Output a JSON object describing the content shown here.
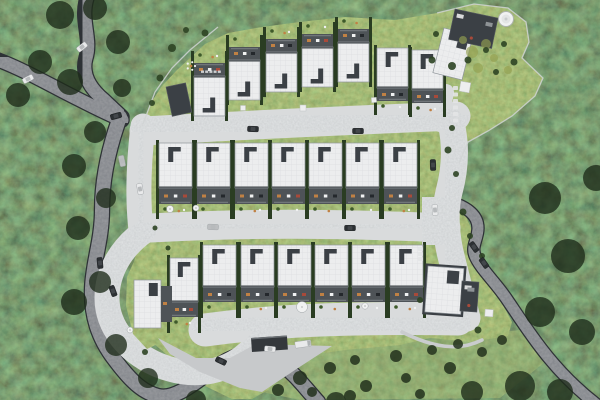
{
  "meta": {
    "scene": "aerial-site-plan-render",
    "width": 600,
    "height": 400
  },
  "colors": {
    "roof": "#ECEDEE",
    "roofGrid": "#DBDDE0",
    "roofEdge": "#8F959A",
    "dark": "#3B4045",
    "darker": "#24282C",
    "terrace": "#4E5357",
    "hedge": "#2A3D22",
    "bush": "#2E4424",
    "lawnTree": "#22301C",
    "cobble": "#B2B6BA",
    "curb": "#D9DBDC",
    "apron": "#C7C9CB",
    "asphalt": "#43474B",
    "asphaltEdge": "#2E3236",
    "carWhite": "#E9EAEB",
    "carDark": "#2C3033",
    "carSilver": "#BCBEC0",
    "orange": "#C08144",
    "red": "#A84A3A",
    "white": "#F1F2F2",
    "fence": "#D0D3D4",
    "stone": "#E3E4E5",
    "meadow": "#93A050",
    "railing": "#7A7F83",
    "canopy": "#1C2A18"
  },
  "site": {
    "outline": "143,124 150,104 162,86 177,70 190,58 205,44 228,33 262,27 300,22 345,17 395,20 437,13 474,4 508,8 526,22 529,42 522,58 543,78 535,96 512,116 488,131 468,142 459,160 461,186 452,200 465,214 475,238 486,268 498,296 512,322 508,336 470,342 430,338 400,345 345,350 310,355 290,368 268,390 252,399 232,399 205,386 175,362 152,342 136,318 130,292 134,262 140,238 138,205 139,170 141,145",
    "island": "148,247 168,254 176,278 176,314 166,340 147,349 133,334 126,306 127,277 136,257",
    "lawn": "250,352 330,346 430,340 520,330 545,362 500,398 300,400 262,392",
    "fences": [
      "218,27 190,50 172,68 155,92 143,124",
      "437,13 474,4 508,8 526,22 529,42 522,58 543,78 535,96 512,116 488,131 468,142 459,163"
    ]
  },
  "roads": {
    "asphalt": [
      {
        "name": "north-access-road",
        "d": "M87,-2 C80,20 92,38 86,58 C81,76 92,90 104,100 C110,106 116,111 122,117",
        "w": 13
      },
      {
        "name": "west-access-road",
        "d": "M-2,60 C25,70 55,88 86,103 C98,109 110,115 122,120",
        "w": 13
      },
      {
        "name": "south-perimeter-road",
        "d": "M120,117 C108,150 102,180 102,210 C102,240 93,262 92,288 C91,315 98,338 115,360 C130,380 142,392 158,396 C180,401 205,372 228,360 C252,348 262,352 278,362 C295,373 305,388 318,402",
        "w": 14
      },
      {
        "name": "east-exit-road",
        "d": "M450,202 C468,207 478,216 478,228 C478,240 470,247 476,258 C482,270 495,282 506,298 C517,314 530,335 548,357 C562,374 578,390 596,404",
        "w": 11
      }
    ],
    "cobble": [
      {
        "name": "upper-lane",
        "d": "M144,131 C230,126 330,121 456,116",
        "w": 26
      },
      {
        "name": "north-east-stub",
        "d": "M446,92 L440,124",
        "w": 13
      },
      {
        "name": "east-connector-lane",
        "d": "M450,119 C457,145 455,170 449,192 C444,212 446,238 452,260 C457,280 462,300 467,318",
        "w": 24
      },
      {
        "name": "middle-lane",
        "d": "M150,228 C240,223 330,223 446,228",
        "w": 26
      },
      {
        "name": "west-connector-lane",
        "d": "M143,126 C139,160 137,195 141,230",
        "w": 22
      },
      {
        "name": "turning-loop",
        "d": "M146,230 C121,247 107,272 107,298 C107,327 128,352 158,365 C190,378 220,374 243,357 C252,350 258,343 263,336",
        "w": 22
      },
      {
        "name": "lower-lane",
        "d": "M205,330 C270,321 340,317 458,319",
        "w": 30
      }
    ],
    "parkingBay": {
      "x": 422,
      "y": 197,
      "w": 26,
      "h": 48
    },
    "apron": "158,338 196,358 230,358 256,344 332,346 298,368 262,392 240,388 200,372 170,354",
    "walkway": "M402,332 C432,347 458,352 482,340"
  },
  "rows": {
    "top": {
      "w": 31,
      "roofH": 40,
      "terrH": 13,
      "gardenH": 12,
      "units": [
        {
          "x": 194,
          "y": 76,
          "terr": "top"
        },
        {
          "x": 229,
          "y": 60,
          "terr": "top"
        },
        {
          "x": 266,
          "y": 52,
          "terr": "top"
        },
        {
          "x": 302,
          "y": 47,
          "terr": "top"
        },
        {
          "x": 338,
          "y": 42,
          "terr": "top"
        },
        {
          "x": 377,
          "y": 48,
          "terr": "bottom"
        },
        {
          "x": 412,
          "y": 50,
          "terr": "bottom"
        }
      ]
    },
    "middle": {
      "w": 33,
      "roofH": 45,
      "terrH": 16,
      "gardenH": 13,
      "units": [
        {
          "x": 159,
          "y": 143,
          "terr": "bottom"
        },
        {
          "x": 197,
          "y": 143,
          "terr": "bottom"
        },
        {
          "x": 235,
          "y": 143,
          "terr": "bottom"
        },
        {
          "x": 272,
          "y": 143,
          "terr": "bottom"
        },
        {
          "x": 309,
          "y": 143,
          "terr": "bottom"
        },
        {
          "x": 346,
          "y": 143,
          "terr": "bottom"
        },
        {
          "x": 384,
          "y": 143,
          "terr": "bottom"
        }
      ]
    },
    "bottom": {
      "w": 33,
      "roofH": 42,
      "terrH": 15,
      "gardenH": 14,
      "units": [
        {
          "x": 170,
          "y": 258,
          "w": 28,
          "roofH": 44,
          "terr": "bottom"
        },
        {
          "x": 203,
          "y": 245,
          "terr": "bottom"
        },
        {
          "x": 241,
          "y": 245,
          "terr": "bottom"
        },
        {
          "x": 278,
          "y": 245,
          "terr": "bottom"
        },
        {
          "x": 315,
          "y": 245,
          "terr": "bottom"
        },
        {
          "x": 352,
          "y": 245,
          "terr": "bottom"
        },
        {
          "x": 390,
          "y": 245,
          "terr": "bottom"
        }
      ]
    }
  },
  "specials": [
    {
      "type": "dark",
      "name": "garage-building",
      "x": 166,
      "y": 87,
      "w": 20,
      "h": 30,
      "rot": -12
    },
    {
      "type": "house",
      "name": "detached-house-ne",
      "x": 444,
      "y": 28,
      "w": 30,
      "h": 46,
      "rot": 14
    },
    {
      "type": "dark",
      "name": "communal-terrace",
      "x": 455,
      "y": 9,
      "w": 44,
      "h": 31,
      "rot": 12,
      "dots": true
    },
    {
      "type": "gazebo",
      "name": "round-gazebo",
      "x": 506,
      "y": 19,
      "r": 7.5
    },
    {
      "type": "house",
      "name": "loop-corner-house",
      "x": 134,
      "y": 280,
      "w": 27,
      "h": 48,
      "rot": 0,
      "sideTerr": true
    },
    {
      "type": "house",
      "name": "clubhouse",
      "x": 428,
      "y": 266,
      "w": 36,
      "h": 46,
      "rot": 4,
      "frame": true
    },
    {
      "type": "dark",
      "name": "clubhouse-annex",
      "x": 462,
      "y": 281,
      "w": 17,
      "h": 30,
      "rot": 4,
      "dots": true
    },
    {
      "type": "booth",
      "name": "entrance-gate-canopy",
      "x": 251,
      "y": 338,
      "w": 36,
      "h": 14,
      "rot": -4
    }
  ],
  "cars": [
    {
      "x": 82,
      "y": 47,
      "rot": -38,
      "c": "white"
    },
    {
      "x": 28,
      "y": 79,
      "rot": -28,
      "c": "white"
    },
    {
      "x": 116,
      "y": 116,
      "rot": -15,
      "c": "dark"
    },
    {
      "x": 122,
      "y": 161,
      "rot": 78,
      "c": "silver"
    },
    {
      "x": 140,
      "y": 189,
      "rot": 80,
      "c": "white"
    },
    {
      "x": 100,
      "y": 263,
      "rot": 85,
      "c": "dark"
    },
    {
      "x": 113,
      "y": 291,
      "rot": 70,
      "c": "dark"
    },
    {
      "x": 253,
      "y": 129,
      "rot": 2,
      "c": "dark"
    },
    {
      "x": 358,
      "y": 131,
      "rot": 0,
      "c": "dark"
    },
    {
      "x": 433,
      "y": 165,
      "rot": 88,
      "c": "dark"
    },
    {
      "x": 435,
      "y": 210,
      "rot": 86,
      "c": "white"
    },
    {
      "x": 474,
      "y": 247,
      "rot": 55,
      "c": "dark"
    },
    {
      "x": 484,
      "y": 263,
      "rot": 55,
      "c": "dark"
    },
    {
      "x": 213,
      "y": 227,
      "rot": 2,
      "c": "silver"
    },
    {
      "x": 350,
      "y": 228,
      "rot": 0,
      "c": "dark"
    },
    {
      "x": 221,
      "y": 361,
      "rot": 25,
      "c": "dark"
    },
    {
      "x": 270,
      "y": 349,
      "rot": 5,
      "c": "white"
    },
    {
      "x": 303,
      "y": 344,
      "rot": -8,
      "c": "white",
      "kind": "truck"
    }
  ],
  "props": {
    "parasols": [
      [
        170,
        209,
        3.5
      ],
      [
        196,
        208,
        3
      ],
      [
        302,
        307,
        5.5
      ],
      [
        365,
        306,
        3.2
      ],
      [
        130,
        330,
        3
      ]
    ],
    "pads": [
      [
        465,
        87,
        10,
        10,
        10
      ],
      [
        489,
        313,
        8,
        7,
        4
      ],
      [
        303,
        108,
        6,
        6,
        0
      ],
      [
        243,
        108,
        5,
        5,
        0
      ],
      [
        374,
        100,
        5,
        5,
        -4
      ]
    ],
    "stonesCols": [
      [
        453,
        86,
        6,
        6.5
      ],
      [
        418,
        247,
        3,
        5
      ]
    ],
    "stonesRow": [
      201,
      70.5,
      5,
      4.2
    ],
    "playground": [
      191,
      66
    ],
    "meadow": [
      [
        472,
        52,
        6
      ],
      [
        486,
        44,
        5
      ],
      [
        478,
        68,
        5
      ],
      [
        463,
        40,
        4
      ],
      [
        494,
        58,
        4
      ],
      [
        508,
        70,
        4
      ]
    ],
    "bushes": [
      [
        172,
        48,
        4
      ],
      [
        160,
        78,
        3.5
      ],
      [
        152,
        103,
        3
      ],
      [
        205,
        33,
        3.5
      ],
      [
        436,
        34,
        3
      ],
      [
        432,
        60,
        3.5
      ],
      [
        452,
        66,
        4
      ],
      [
        468,
        60,
        3.5
      ],
      [
        486,
        50,
        3
      ],
      [
        504,
        44,
        3
      ],
      [
        514,
        62,
        3.5
      ],
      [
        496,
        72,
        3
      ],
      [
        452,
        128,
        3
      ],
      [
        448,
        150,
        3.5
      ],
      [
        456,
        174,
        3
      ],
      [
        463,
        212,
        3.5
      ],
      [
        470,
        236,
        3
      ],
      [
        482,
        256,
        3
      ],
      [
        420,
        300,
        3
      ],
      [
        478,
        330,
        3.5
      ],
      [
        155,
        228,
        2.5
      ],
      [
        168,
        248,
        2.5
      ],
      [
        145,
        352,
        3
      ],
      [
        186,
        30,
        3
      ]
    ],
    "lawnTrees": [
      [
        300,
        378,
        7
      ],
      [
        330,
        368,
        6
      ],
      [
        355,
        360,
        5
      ],
      [
        396,
        356,
        6
      ],
      [
        432,
        350,
        5
      ],
      [
        458,
        344,
        5
      ],
      [
        278,
        390,
        6
      ],
      [
        312,
        392,
        5
      ],
      [
        366,
        386,
        6
      ],
      [
        406,
        378,
        5
      ],
      [
        450,
        368,
        6
      ],
      [
        482,
        352,
        5
      ],
      [
        502,
        340,
        5
      ],
      [
        350,
        396,
        6
      ],
      [
        420,
        394,
        5
      ]
    ],
    "canopies": [
      [
        60,
        15,
        14
      ],
      [
        95,
        8,
        12
      ],
      [
        118,
        42,
        12
      ],
      [
        40,
        62,
        12
      ],
      [
        70,
        82,
        13
      ],
      [
        18,
        95,
        12
      ],
      [
        122,
        88,
        9
      ],
      [
        95,
        132,
        11
      ],
      [
        74,
        166,
        12
      ],
      [
        106,
        198,
        10
      ],
      [
        78,
        228,
        12
      ],
      [
        100,
        282,
        11
      ],
      [
        74,
        302,
        13
      ],
      [
        116,
        345,
        11
      ],
      [
        148,
        378,
        10
      ],
      [
        196,
        400,
        10
      ],
      [
        336,
        402,
        10
      ],
      [
        545,
        198,
        16
      ],
      [
        568,
        256,
        17
      ],
      [
        540,
        312,
        15
      ],
      [
        582,
        332,
        13
      ],
      [
        520,
        386,
        15
      ],
      [
        560,
        392,
        13
      ],
      [
        596,
        178,
        13
      ],
      [
        472,
        392,
        11
      ]
    ]
  }
}
